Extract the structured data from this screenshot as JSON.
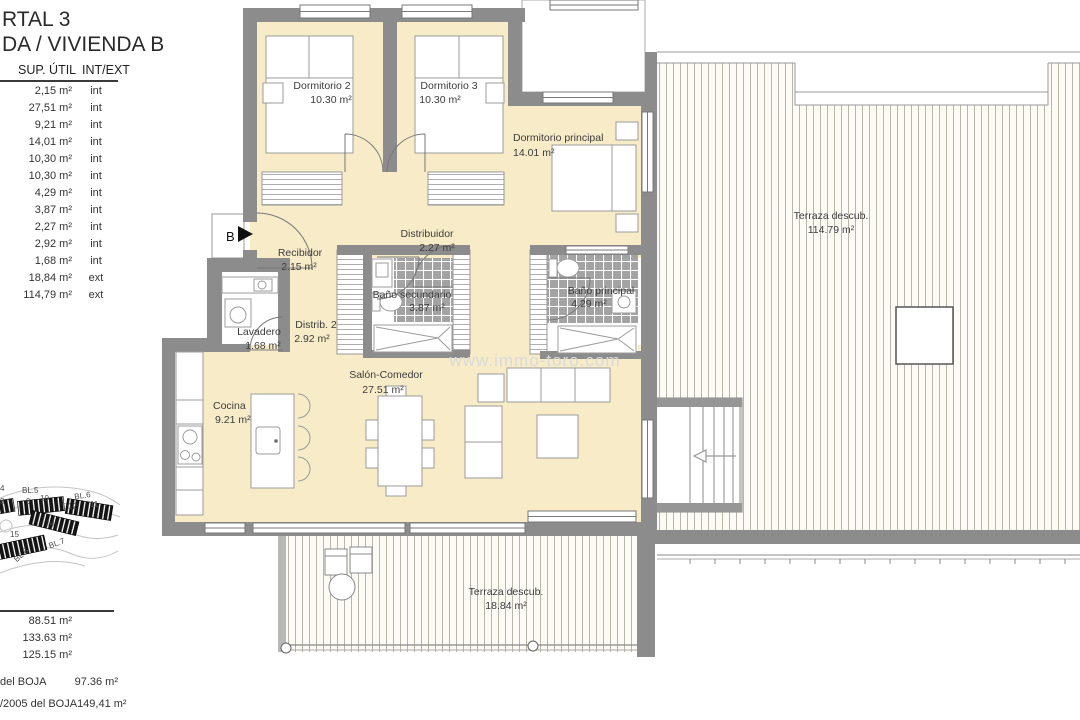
{
  "header": {
    "title_line1": "RTAL 3",
    "title_line2": "DA / VIVIENDA B"
  },
  "area_table": {
    "col_sup": "SUP. ÚTIL",
    "col_intext": "INT/EXT",
    "rows": [
      {
        "sup": "2,15 m²",
        "loc": "int"
      },
      {
        "sup": "27,51 m²",
        "loc": "int"
      },
      {
        "sup": "9,21 m²",
        "loc": "int"
      },
      {
        "sup": "14,01 m²",
        "loc": "int"
      },
      {
        "sup": "10,30 m²",
        "loc": "int"
      },
      {
        "sup": "10,30 m²",
        "loc": "int"
      },
      {
        "sup": "4,29 m²",
        "loc": "int"
      },
      {
        "sup": "3,87 m²",
        "loc": "int"
      },
      {
        "sup": "2,27 m²",
        "loc": "int"
      },
      {
        "sup": "2,92 m²",
        "loc": "int"
      },
      {
        "sup": "1,68 m²",
        "loc": "int"
      },
      {
        "sup": "18,84 m²",
        "loc": "ext"
      },
      {
        "sup": "114,79 m²",
        "loc": "ext"
      }
    ]
  },
  "totals": {
    "values": [
      "88.51 m²",
      "133.63 m²",
      "125.15 m²"
    ]
  },
  "boja": {
    "rows": [
      {
        "label": "del BOJA",
        "value": "97.36 m²"
      },
      {
        "label": "/2005 del BOJA",
        "value": "149,41 m²"
      }
    ]
  },
  "plan": {
    "entrance_label": "B",
    "watermark": "www.immo-toro.com",
    "rooms": [
      {
        "name": "Dormitorio 2",
        "area": "10.30 m²"
      },
      {
        "name": "Dormitorio 3",
        "area": "10.30 m²"
      },
      {
        "name": "Dormitorio principal",
        "area": "14.01 m²"
      },
      {
        "name": "Recibidor",
        "area": "2.15 m²"
      },
      {
        "name": "Distribuidor",
        "area": "2.27 m²"
      },
      {
        "name": "Baño secundario",
        "area": "3.87 m²"
      },
      {
        "name": "Baño principal",
        "area": "4.29 m²"
      },
      {
        "name": "Lavadero",
        "area": "1.68 m²"
      },
      {
        "name": "Distrib. 2",
        "area": "2.92 m²"
      },
      {
        "name": "Salón-Comedor",
        "area": "27.51 m²"
      },
      {
        "name": "Cocina",
        "area": "9.21 m²"
      },
      {
        "name": "Terraza descub.",
        "area": "114.79 m²"
      },
      {
        "name": "Terraza descub.",
        "area": "18.84 m²"
      }
    ]
  },
  "minimap": {
    "labels": [
      "4",
      "BL.5",
      "8",
      "9",
      "10",
      "BL.6",
      "12",
      "11",
      "14",
      "15",
      "BL.7",
      "BL.8"
    ]
  },
  "colors": {
    "wall": "#8c8c8c",
    "room_fill": "#f7ebc8",
    "tile": "#a3a3a3",
    "deck_line": "#b8b5aa"
  }
}
